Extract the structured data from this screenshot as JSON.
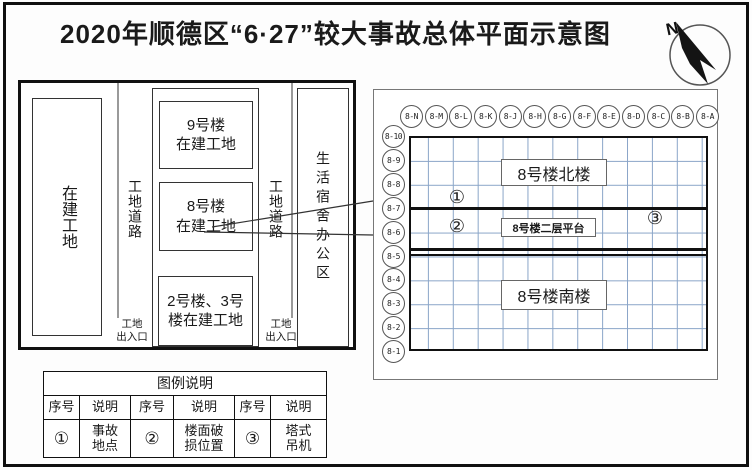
{
  "title": "2020年顺德区“6·27”较大事故总体平面示意图",
  "compass": {
    "north_label": "N"
  },
  "site_plan": {
    "left_lot_label": "在建工地",
    "road_left_label": "工地道路",
    "road_right_label": "工地道路",
    "building_9_label": "9号楼\n在建工地",
    "building_8_label": "8号楼\n在建工地",
    "building_2_3_label": "2号楼、3号\n楼在建工地",
    "dorm_office_label": "生活宿舍办公区",
    "gate_left_label": "工地\n出入口",
    "gate_right_label": "工地\n出入口"
  },
  "detail_plan": {
    "column_axes": [
      "8-N",
      "8-M",
      "8-L",
      "8-K",
      "8-J",
      "8-H",
      "8-G",
      "8-F",
      "8-E",
      "8-D",
      "8-C",
      "8-B",
      "8-A"
    ],
    "row_axes": [
      "8-10",
      "8-9",
      "8-8",
      "8-7",
      "8-6",
      "8-5",
      "8-4",
      "8-3",
      "8-2",
      "8-1"
    ],
    "north_building_label": "8号楼北楼",
    "platform_label": "8号楼二层平台",
    "south_building_label": "8号楼南楼",
    "markers": {
      "accident": "①",
      "damage": "②",
      "crane": "③"
    }
  },
  "legend": {
    "title": "图例说明",
    "headers": [
      "序号",
      "说明",
      "序号",
      "说明",
      "序号",
      "说明"
    ],
    "row": [
      "①",
      "事故\n地点",
      "②",
      "楼面破\n损位置",
      "③",
      "塔式\n吊机"
    ]
  },
  "colors": {
    "line": "#1a1a1a",
    "grid_blue": "#8aa5c8",
    "gray": "#8a8a8a"
  }
}
